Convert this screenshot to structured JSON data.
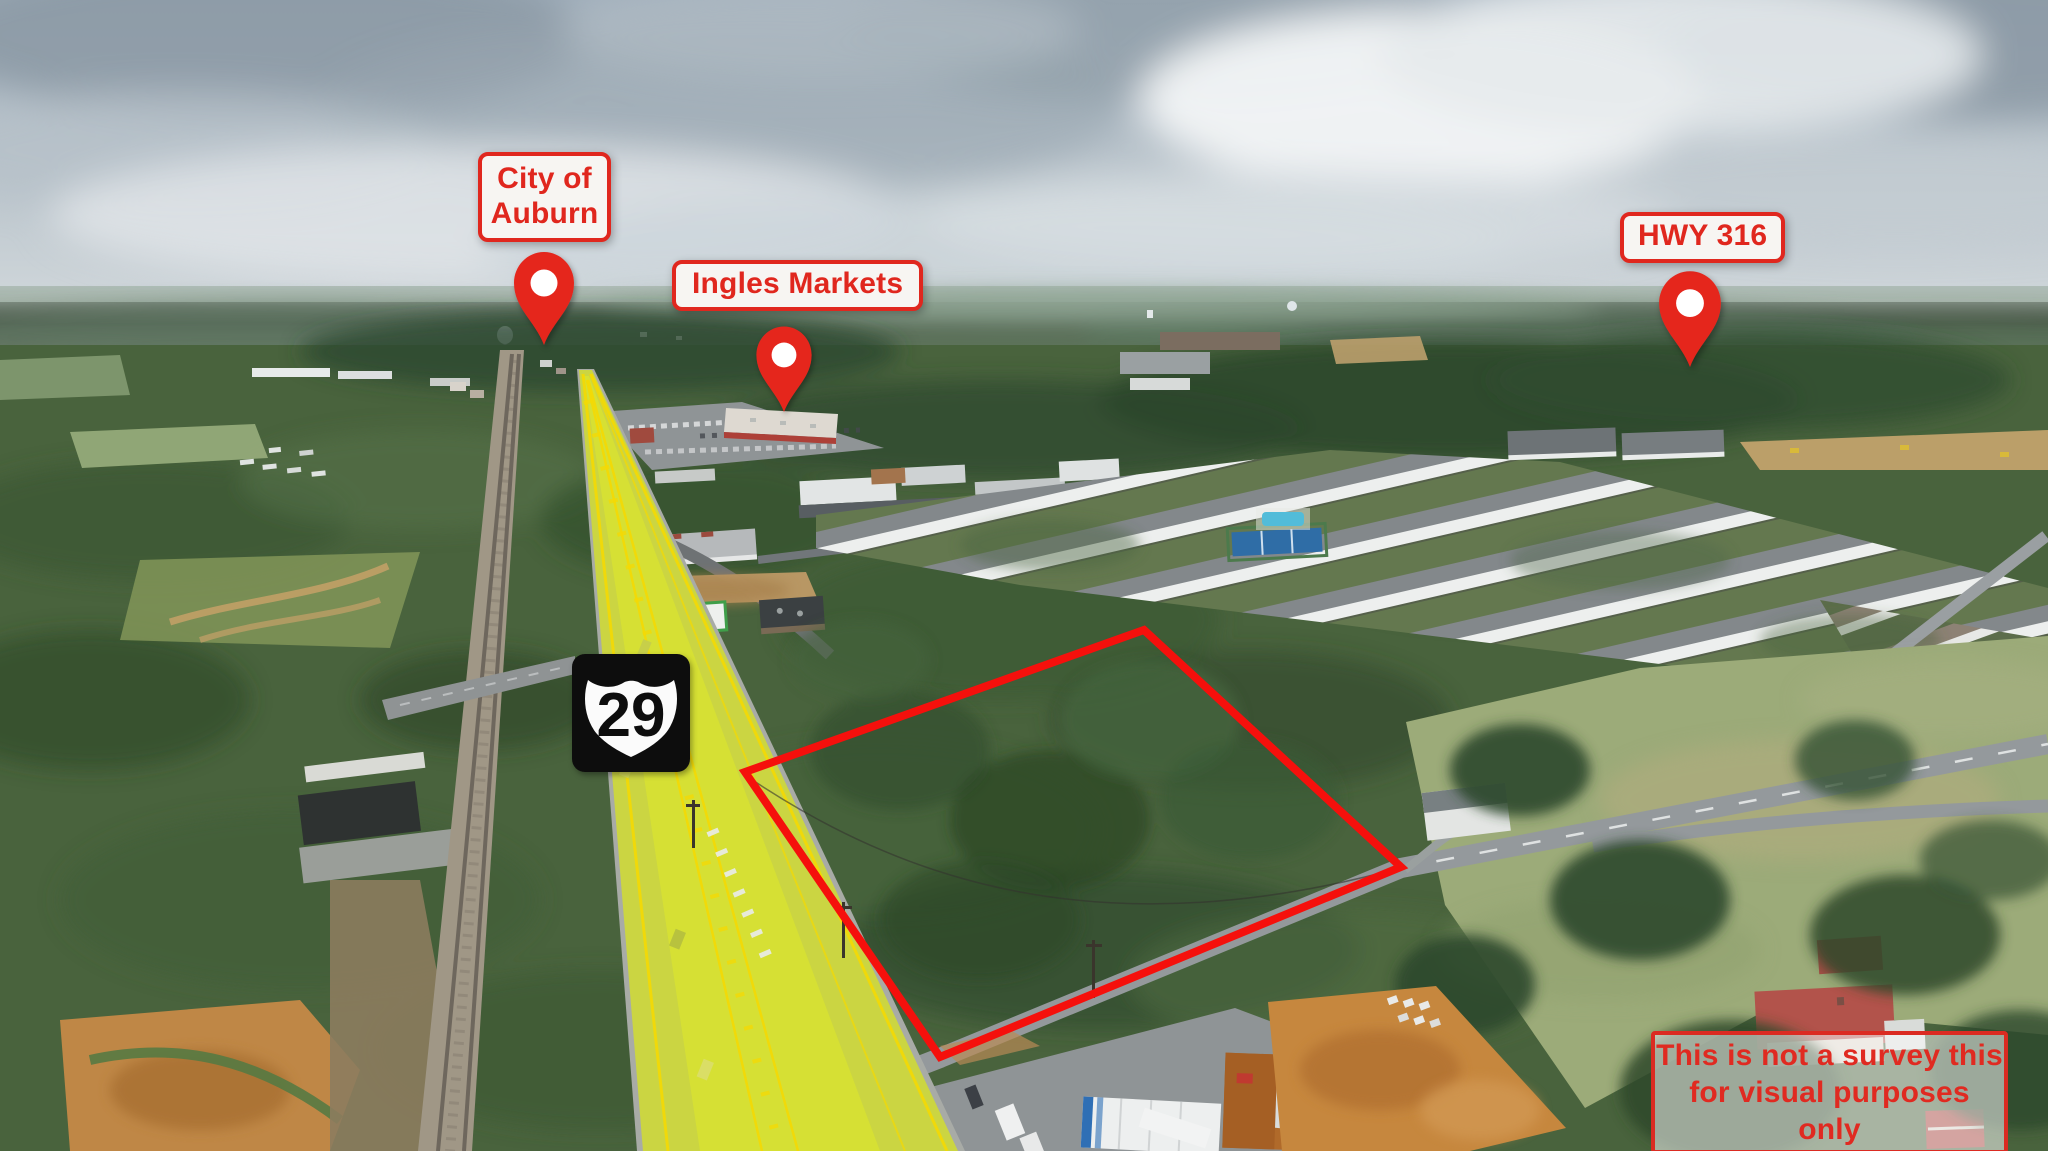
{
  "annotations": {
    "city_label": {
      "line1": "City of",
      "line2": "Auburn"
    },
    "ingles_label": {
      "text": "Ingles Markets"
    },
    "hwy_label": {
      "text": "HWY 316"
    },
    "route_shield": {
      "number": "29"
    },
    "disclaimer": {
      "line1": "This is not a survey this",
      "line2": "for visual purposes only"
    }
  },
  "icons": [
    {
      "name": "map-pin-city-of-auburn",
      "glyph": "red map pin"
    },
    {
      "name": "map-pin-ingles-markets",
      "glyph": "red map pin"
    },
    {
      "name": "map-pin-hwy-316",
      "glyph": "red map pin"
    },
    {
      "name": "us-route-29-shield",
      "glyph": "US highway shield on black square"
    }
  ],
  "colors": {
    "annotation_red": "#e5261f",
    "boundary_red": "#f5100c",
    "highway_highlight_yellow": "#e2f200",
    "label_background": "#f7f5f2",
    "disclaimer_background": "rgba(255,255,255,0.52)"
  }
}
